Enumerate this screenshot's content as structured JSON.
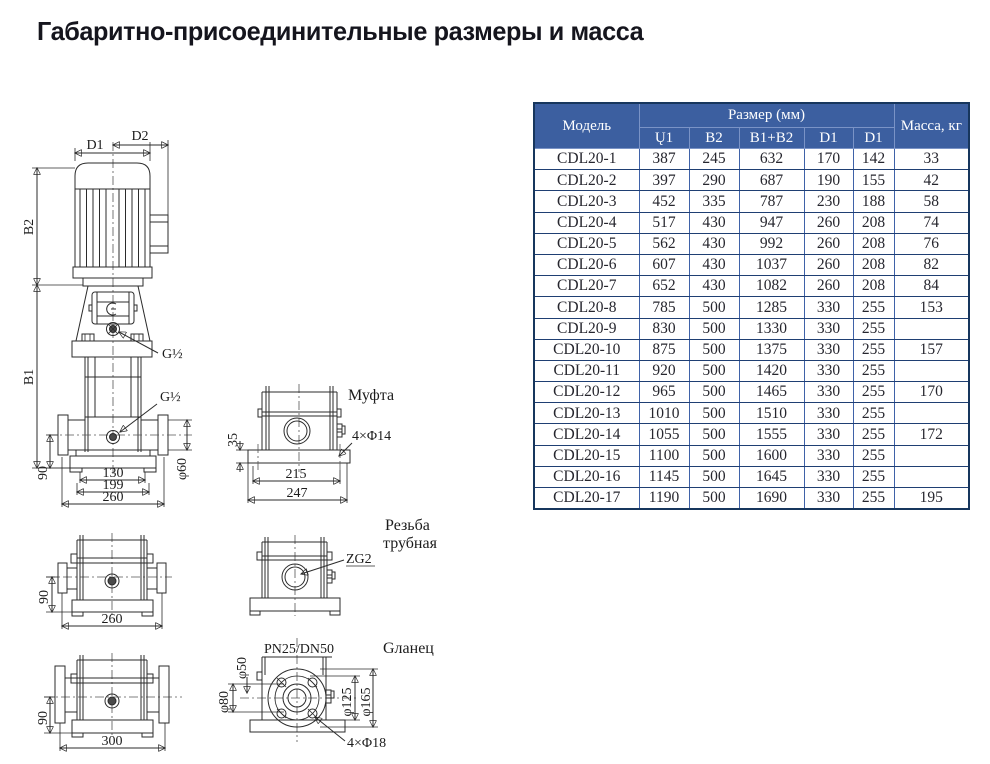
{
  "page": {
    "title": "Габаритно-присоединительные размеры и масса"
  },
  "colors": {
    "table_header_bg": "#3c5fa0",
    "table_border": "#17365d",
    "table_header_text": "#ffffff"
  },
  "table": {
    "header": {
      "model": "Модель",
      "size_group": "Размер (мм)",
      "size_cols": [
        "Ų1",
        "B2",
        "B1+B2",
        "D1",
        "D1"
      ],
      "mass": "Масса, кг"
    },
    "rows": [
      {
        "model": "CDL20-1",
        "u1": "387",
        "b2": "245",
        "b1b2": "632",
        "d1a": "170",
        "d1b": "142",
        "mass": "33"
      },
      {
        "model": "CDL20-2",
        "u1": "397",
        "b2": "290",
        "b1b2": "687",
        "d1a": "190",
        "d1b": "155",
        "mass": "42"
      },
      {
        "model": "CDL20-3",
        "u1": "452",
        "b2": "335",
        "b1b2": "787",
        "d1a": "230",
        "d1b": "188",
        "mass": "58"
      },
      {
        "model": "CDL20-4",
        "u1": "517",
        "b2": "430",
        "b1b2": "947",
        "d1a": "260",
        "d1b": "208",
        "mass": "74"
      },
      {
        "model": "CDL20-5",
        "u1": "562",
        "b2": "430",
        "b1b2": "992",
        "d1a": "260",
        "d1b": "208",
        "mass": "76"
      },
      {
        "model": "CDL20-6",
        "u1": "607",
        "b2": "430",
        "b1b2": "1037",
        "d1a": "260",
        "d1b": "208",
        "mass": "82"
      },
      {
        "model": "CDL20-7",
        "u1": "652",
        "b2": "430",
        "b1b2": "1082",
        "d1a": "260",
        "d1b": "208",
        "mass": "84"
      },
      {
        "model": "CDL20-8",
        "u1": "785",
        "b2": "500",
        "b1b2": "1285",
        "d1a": "330",
        "d1b": "255",
        "mass": "153"
      },
      {
        "model": "CDL20-9",
        "u1": "830",
        "b2": "500",
        "b1b2": "1330",
        "d1a": "330",
        "d1b": "255",
        "mass": ""
      },
      {
        "model": "CDL20-10",
        "u1": "875",
        "b2": "500",
        "b1b2": "1375",
        "d1a": "330",
        "d1b": "255",
        "mass": "157"
      },
      {
        "model": "CDL20-11",
        "u1": "920",
        "b2": "500",
        "b1b2": "1420",
        "d1a": "330",
        "d1b": "255",
        "mass": ""
      },
      {
        "model": "CDL20-12",
        "u1": "965",
        "b2": "500",
        "b1b2": "1465",
        "d1a": "330",
        "d1b": "255",
        "mass": "170"
      },
      {
        "model": "CDL20-13",
        "u1": "1010",
        "b2": "500",
        "b1b2": "1510",
        "d1a": "330",
        "d1b": "255",
        "mass": ""
      },
      {
        "model": "CDL20-14",
        "u1": "1055",
        "b2": "500",
        "b1b2": "1555",
        "d1a": "330",
        "d1b": "255",
        "mass": "172"
      },
      {
        "model": "CDL20-15",
        "u1": "1100",
        "b2": "500",
        "b1b2": "1600",
        "d1a": "330",
        "d1b": "255",
        "mass": ""
      },
      {
        "model": "CDL20-16",
        "u1": "1145",
        "b2": "500",
        "b1b2": "1645",
        "d1a": "330",
        "d1b": "255",
        "mass": ""
      },
      {
        "model": "CDL20-17",
        "u1": "1190",
        "b2": "500",
        "b1b2": "1690",
        "d1a": "330",
        "d1b": "255",
        "mass": "195"
      }
    ]
  },
  "drawings": {
    "pump_front": {
      "dim_d1": "D1",
      "dim_d2": "D2",
      "dim_b2": "B2",
      "dim_b1": "B1",
      "thread_top": "G½",
      "thread_side": "G½",
      "dim_90": "90",
      "dim_130": "130",
      "dim_199": "199",
      "dim_260": "260",
      "dim_phi60": "φ60"
    },
    "coupling_view": {
      "caption": "Муфта",
      "dim_35": "35",
      "dim_215": "215",
      "dim_247": "247",
      "holes": "4×Φ14"
    },
    "coupling_base": {
      "dim_90": "90",
      "dim_260": "260"
    },
    "thread_view": {
      "caption_line1": "Резьба",
      "caption_line2": "трубная",
      "thread": "ZG2"
    },
    "flange_base": {
      "dim_90": "90",
      "dim_300": "300"
    },
    "flange_view": {
      "rating": "PN25/DN50",
      "caption": "Gланец",
      "dim_phi50": "φ50",
      "dim_phi80": "φ80",
      "dim_phi125": "φ125",
      "dim_phi165": "φ165",
      "holes": "4×Φ18"
    }
  }
}
